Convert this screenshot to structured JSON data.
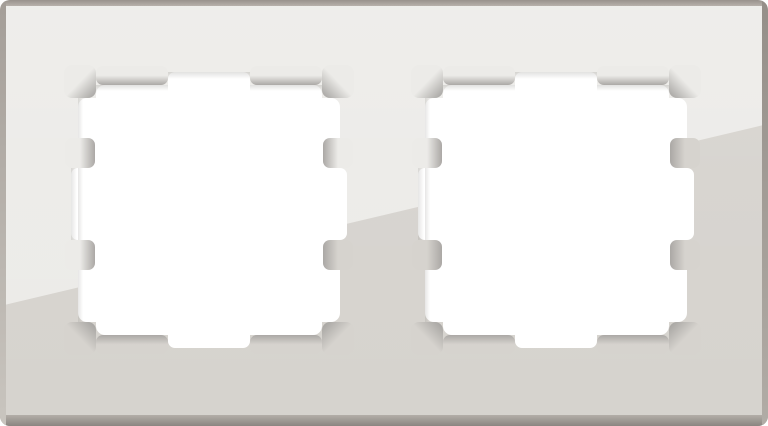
{
  "image": {
    "subject": "double-gang-glass-frame",
    "opening_count": 2
  },
  "colors": {
    "page_background": "#FFFFFF",
    "hole_white": "#FFFFFF",
    "glass_light": "#ECEBE8",
    "glass_dark": "#D6D3CE",
    "bevel_tip": "#ABA8A5",
    "bevel_tip_dark": "#A2A09D",
    "cut_shadow": "#8F8D89",
    "band_top_outer": "#98928C",
    "band_top_inner": "#B7B1AB",
    "band_bottom_inner": "#B3AEA8",
    "band_bottom_outer": "#8A8580",
    "band_left_top": "#A49E98",
    "band_left_bottom": "#C9C5BF",
    "band_right_top": "#958F89",
    "band_right_bottom": "#B1ACA6",
    "sheen": "#FFFFFF"
  }
}
